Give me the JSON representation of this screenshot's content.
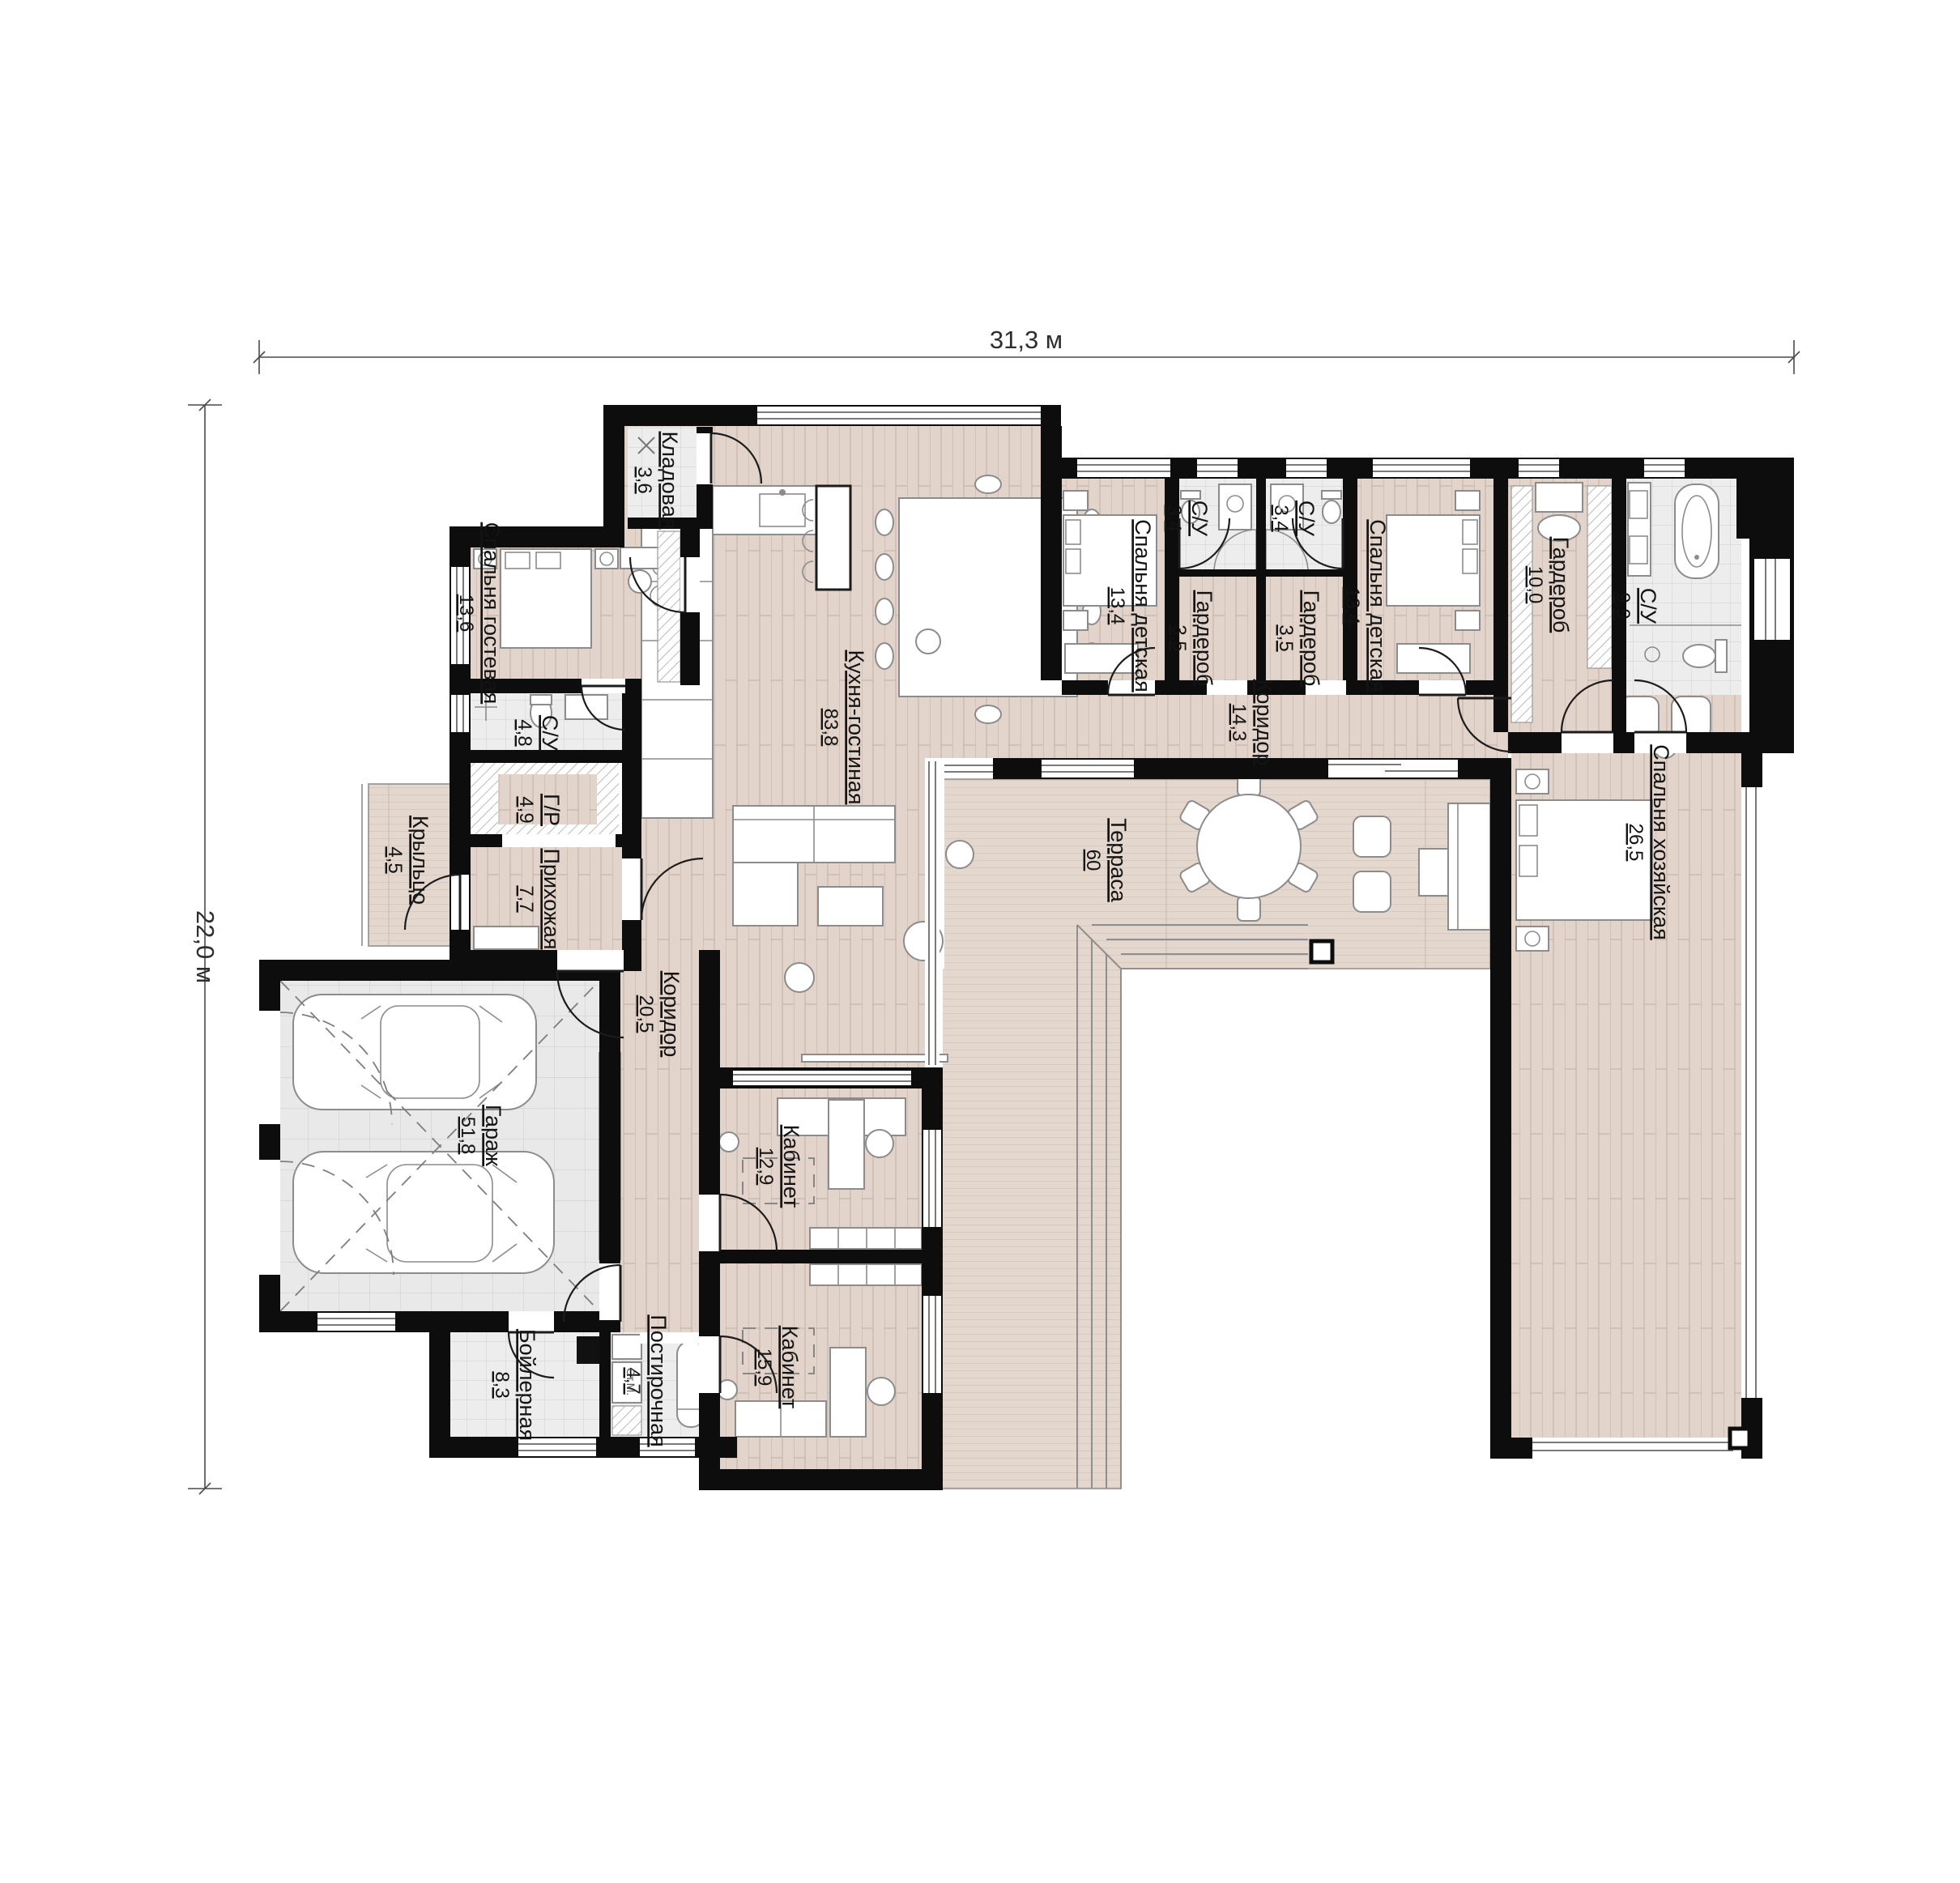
{
  "title": "План одноэтажного дома",
  "dimensions": {
    "width_label": "31,3 м",
    "height_label": "22,0 м"
  },
  "appliances": {
    "washer": "Ст.М."
  },
  "colors": {
    "wall": "#0d0d0d",
    "wood_floor": "#e2d4ca",
    "deck": "#e4d7cd",
    "tile": "#ededed",
    "garage_tile": "#e9e9e9"
  },
  "rooms": [
    {
      "name": "Кладовая",
      "area": "3,6"
    },
    {
      "name": "Спальня гостевая",
      "area": "13,6"
    },
    {
      "name": "С/У",
      "area": "4,8"
    },
    {
      "name": "Г/Р",
      "area": "4,9"
    },
    {
      "name": "Прихожая",
      "area": "7,7"
    },
    {
      "name": "Крыльцо",
      "area": "4,5"
    },
    {
      "name": "Гараж",
      "area": "51,8"
    },
    {
      "name": "Коридор",
      "area": "20,5"
    },
    {
      "name": "Кухня-гостиная",
      "area": "83,8"
    },
    {
      "name": "Спальня детская",
      "area": "13,4"
    },
    {
      "name": "С/У",
      "area": "3,4"
    },
    {
      "name": "Гардероб",
      "area": "3,5"
    },
    {
      "name": "С/У",
      "area": "3,4"
    },
    {
      "name": "Гардероб",
      "area": "3,5"
    },
    {
      "name": "Спальня детская",
      "area": "13,4"
    },
    {
      "name": "Гардероб",
      "area": "10,0"
    },
    {
      "name": "С/У",
      "area": "9,9"
    },
    {
      "name": "Коридор",
      "area": "14,3"
    },
    {
      "name": "Терраса",
      "area": "60"
    },
    {
      "name": "Спальня хозяйская",
      "area": "26,5"
    },
    {
      "name": "Кабинет",
      "area": "12,9"
    },
    {
      "name": "Кабинет",
      "area": "15,9"
    },
    {
      "name": "Бойлерная",
      "area": "8,3"
    },
    {
      "name": "Постирочная",
      "area": "4,7"
    }
  ]
}
